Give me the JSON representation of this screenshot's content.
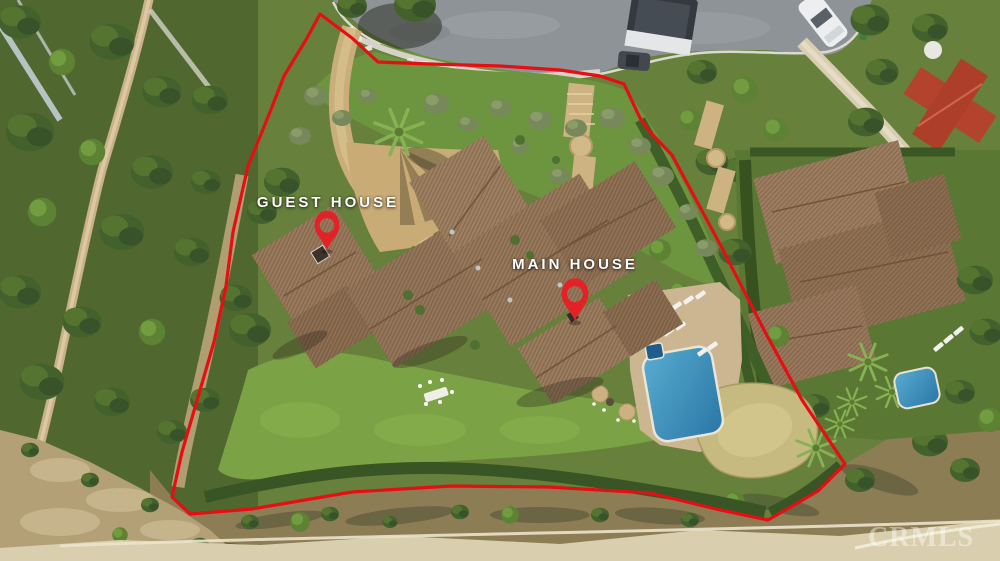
{
  "photo": {
    "type": "aerial-drone-photo",
    "scene": "Luxury estate with tile-roof main house, guest house, pool, lawns, hillside trail and cul-de-sac street, property line outlined in red"
  },
  "annotations": {
    "boundary_color": "#e60e13",
    "pin_color": "#e32227",
    "label_color": "#ffffff",
    "pins": [
      {
        "id": "guest-house",
        "label": "GUEST HOUSE",
        "icon": "location-pin-icon"
      },
      {
        "id": "main-house",
        "label": "MAIN HOUSE",
        "icon": "location-pin-icon"
      }
    ]
  },
  "watermark": {
    "text": "CRMLS"
  }
}
